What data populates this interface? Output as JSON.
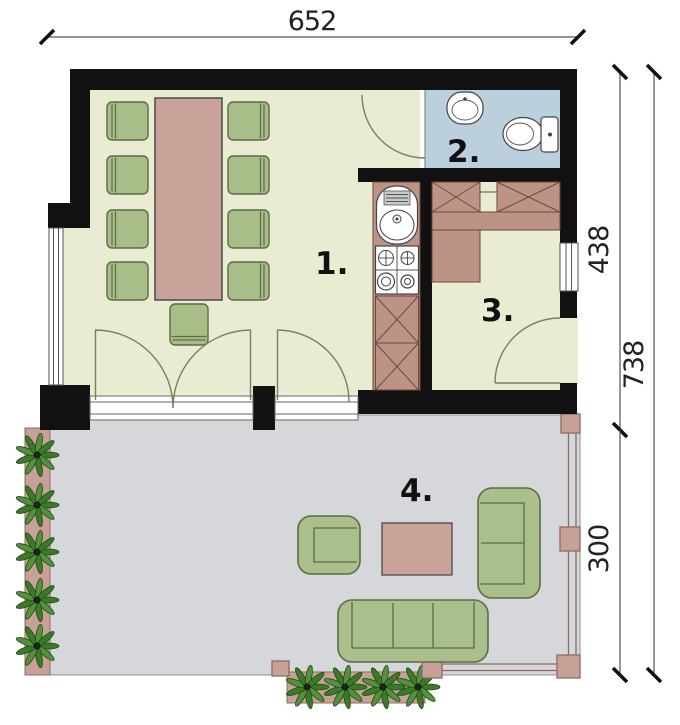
{
  "title": "house floor plan",
  "dimensions": {
    "top_width": "652",
    "upper_height": "438",
    "total_height": "738",
    "terrace_height": "300"
  },
  "room_labels": {
    "room1": "1.",
    "room2": "2.",
    "room3": "3.",
    "room4": "4."
  },
  "colors": {
    "wall": "#111111",
    "room_floor": "#e9ecd2",
    "bathroom_floor": "#bccfdd",
    "terrace_floor": "#d6d7da",
    "counter_wood": "#bd9384",
    "table_wood": "#c9a29a",
    "planter": "#c7a197",
    "furniture_green": "#abbf8d",
    "furniture_green_border": "#5c6c44",
    "plant_green": "#3c7a2a",
    "dimension_line": "#555555"
  }
}
